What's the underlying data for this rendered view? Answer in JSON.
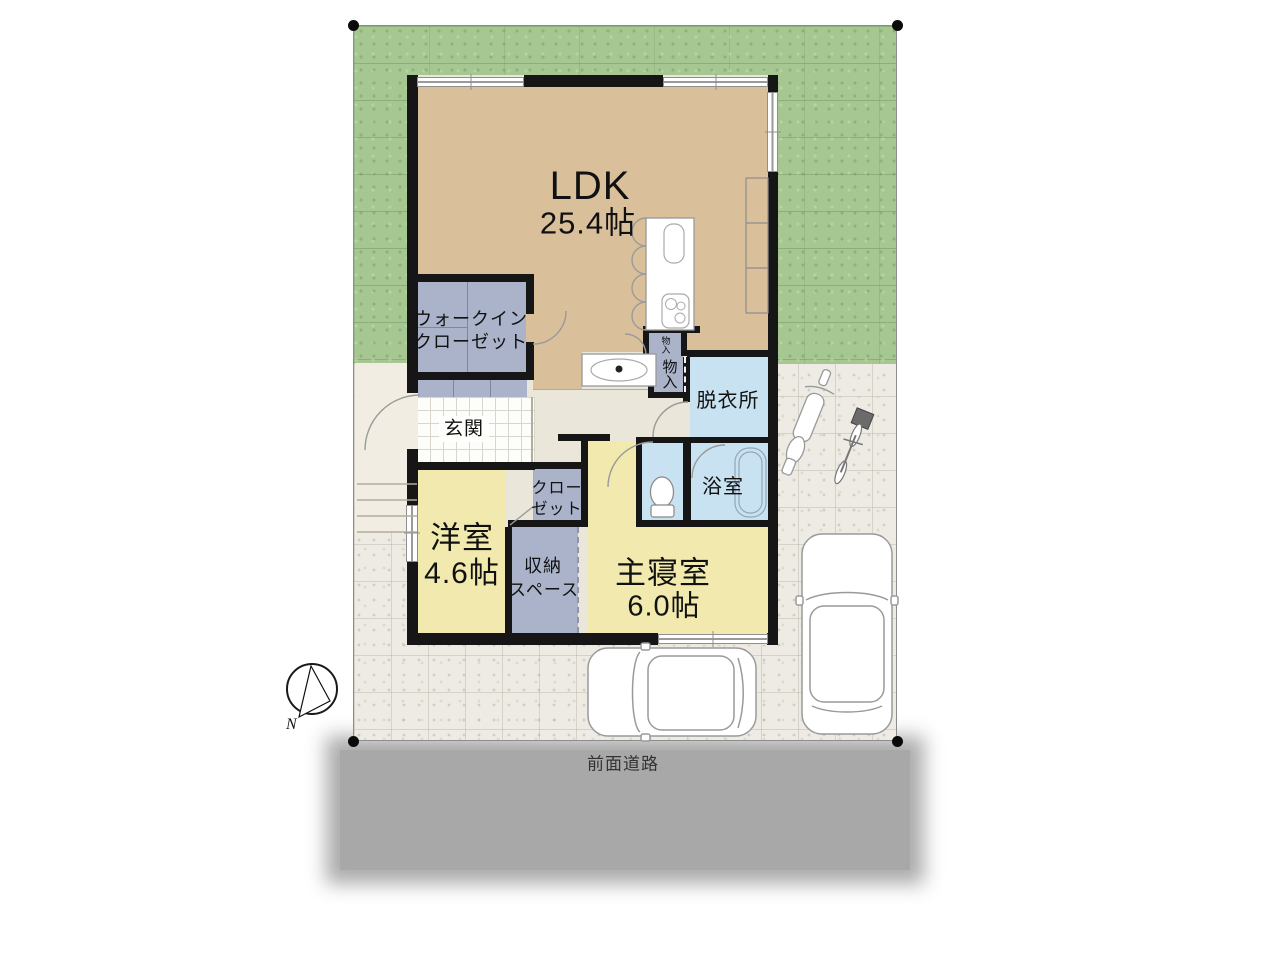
{
  "site": {
    "road_label": "前面道路",
    "compass_north": "N"
  },
  "rooms": {
    "ldk": {
      "name": "LDK",
      "area": "25.4帖"
    },
    "walk_in_closet": {
      "line1": "ウォークイン",
      "line2": "クローゼット"
    },
    "entrance": {
      "name": "玄関"
    },
    "dressing_room": {
      "name": "脱衣所"
    },
    "bathroom": {
      "name": "浴室"
    },
    "western_room": {
      "name": "洋室",
      "area": "4.6帖"
    },
    "closet": {
      "line1": "クロー",
      "line2": "ゼット"
    },
    "storage_space": {
      "line1": "収納",
      "line2": "スペース"
    },
    "master_bedroom": {
      "name": "主寝室",
      "area": "6.0帖"
    },
    "storage_upper": {
      "name": "物入"
    },
    "storage_lower": {
      "name": "物入"
    }
  },
  "colors": {
    "grass": "#a6c791",
    "paving": "#edebe4",
    "ldk_floor": "#d9c09b",
    "hall_floor": "#ebe6da",
    "room_yellow": "#f1e9ad",
    "storage_blue": "#aab3ca",
    "wet_blue": "#c9e2f2",
    "wall": "#161616",
    "road": "#a8a8a8"
  }
}
